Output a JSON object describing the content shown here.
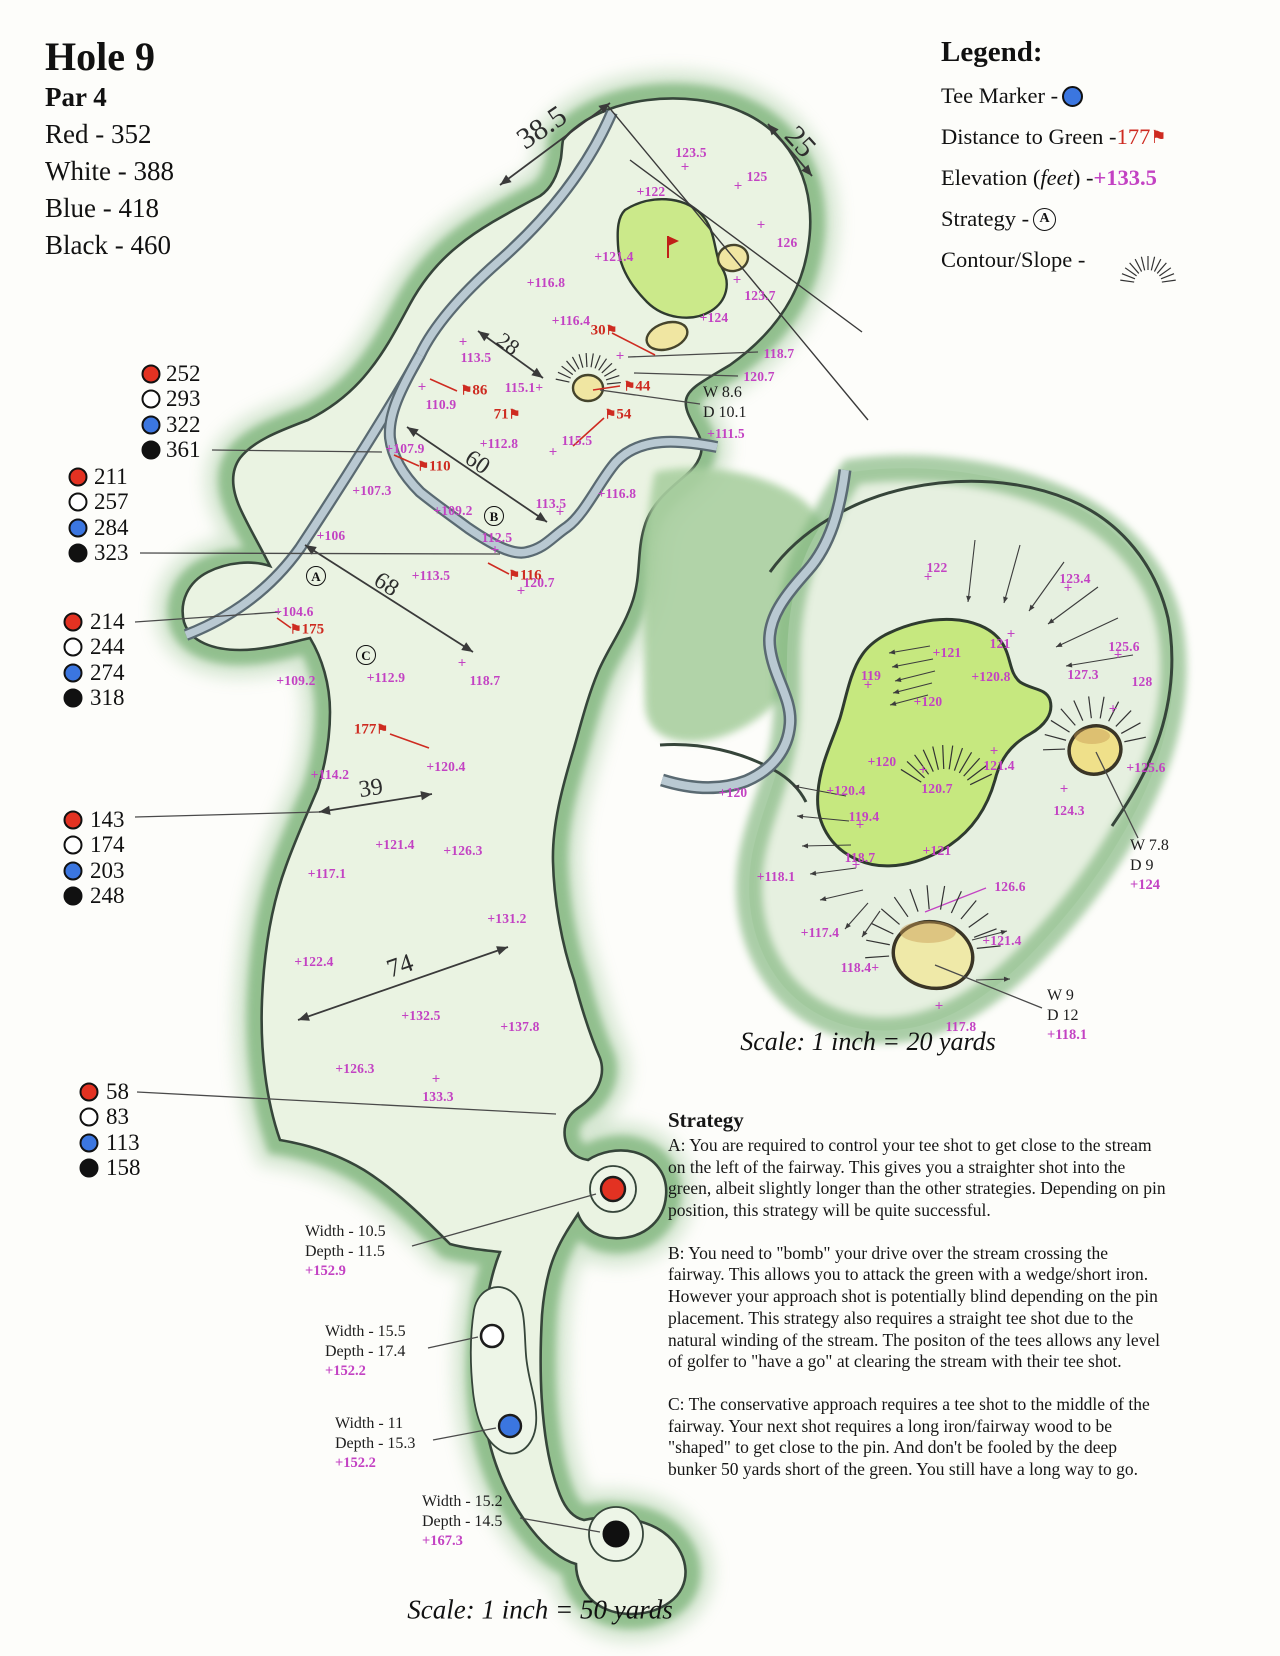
{
  "header": {
    "title": "Hole 9",
    "par": "Par 4",
    "tees": [
      "Red - 352",
      "White - 388",
      "Blue - 418",
      "Black - 460"
    ]
  },
  "legend": {
    "title": "Legend:",
    "tee_marker_label": "Tee Marker - ",
    "distance_label": "Distance to Green - ",
    "distance_value": "177",
    "elevation_pre": "Elevation (",
    "elevation_feet": "feet",
    "elevation_post": ") - ",
    "elevation_value": "+133.5",
    "strategy_label": "Strategy - ",
    "strategy_symbol": "A",
    "contour_label": "Contour/Slope - "
  },
  "colors": {
    "elev": "#c342c3",
    "dist": "#ce2b21",
    "rough": "#7fb57c",
    "fairway": "#eaf3e2",
    "outline": "#36453a",
    "green": "#cbe98a",
    "bunker": "#f0e6a2",
    "stream": "#b9c9d2",
    "stream_edge": "#5a6a72",
    "tee_red": "#e33222",
    "tee_blue": "#3b76e0"
  },
  "tee_groups": [
    {
      "dot_x": 151,
      "text_x": 166,
      "y": 374,
      "rows": [
        {
          "c": "red",
          "v": "252"
        },
        {
          "c": "white",
          "v": "293"
        },
        {
          "c": "blue",
          "v": "322"
        },
        {
          "c": "black",
          "v": "361"
        }
      ]
    },
    {
      "dot_x": 78,
      "text_x": 94,
      "y": 477,
      "rows": [
        {
          "c": "red",
          "v": "211"
        },
        {
          "c": "white",
          "v": "257"
        },
        {
          "c": "blue",
          "v": "284"
        },
        {
          "c": "black",
          "v": "323"
        }
      ]
    },
    {
      "dot_x": 73,
      "text_x": 90,
      "y": 622,
      "rows": [
        {
          "c": "red",
          "v": "214"
        },
        {
          "c": "white",
          "v": "244"
        },
        {
          "c": "blue",
          "v": "274"
        },
        {
          "c": "black",
          "v": "318"
        }
      ]
    },
    {
      "dot_x": 73,
      "text_x": 90,
      "y": 820,
      "rows": [
        {
          "c": "red",
          "v": "143"
        },
        {
          "c": "white",
          "v": "174"
        },
        {
          "c": "blue",
          "v": "203"
        },
        {
          "c": "black",
          "v": "248"
        }
      ]
    },
    {
      "dot_x": 89,
      "text_x": 106,
      "y": 1092,
      "rows": [
        {
          "c": "red",
          "v": "58"
        },
        {
          "c": "white",
          "v": "83"
        },
        {
          "c": "blue",
          "v": "113"
        },
        {
          "c": "black",
          "v": "158"
        }
      ]
    }
  ],
  "annotations": {
    "elevations": [
      [
        691,
        153,
        "123.5"
      ],
      [
        757,
        177,
        "125"
      ],
      [
        651,
        192,
        "+122"
      ],
      [
        787,
        243,
        "126"
      ],
      [
        614,
        257,
        "+121.4"
      ],
      [
        760,
        296,
        "123.7"
      ],
      [
        714,
        318,
        "+124"
      ],
      [
        546,
        283,
        "+116.8"
      ],
      [
        571,
        321,
        "+116.4"
      ],
      [
        476,
        358,
        "113.5"
      ],
      [
        441,
        405,
        "110.9"
      ],
      [
        524,
        388,
        "115.1+"
      ],
      [
        726,
        434,
        "+111.5"
      ],
      [
        779,
        354,
        "118.7"
      ],
      [
        759,
        377,
        "120.7"
      ],
      [
        499,
        444,
        "+112.8"
      ],
      [
        577,
        441,
        "115.5"
      ],
      [
        405,
        449,
        "+107.9"
      ],
      [
        372,
        491,
        "+107.3"
      ],
      [
        453,
        511,
        "+109.2"
      ],
      [
        497,
        538,
        "112.5"
      ],
      [
        551,
        504,
        "113.5"
      ],
      [
        617,
        494,
        "+116.8"
      ],
      [
        331,
        536,
        "+106"
      ],
      [
        431,
        576,
        "+113.5"
      ],
      [
        539,
        583,
        "120.7"
      ],
      [
        294,
        612,
        "+104.6"
      ],
      [
        296,
        681,
        "+109.2"
      ],
      [
        386,
        678,
        "+112.9"
      ],
      [
        485,
        681,
        "118.7"
      ],
      [
        446,
        767,
        "+120.4"
      ],
      [
        330,
        775,
        "+114.2"
      ],
      [
        395,
        845,
        "+121.4"
      ],
      [
        463,
        851,
        "+126.3"
      ],
      [
        327,
        874,
        "+117.1"
      ],
      [
        507,
        919,
        "+131.2"
      ],
      [
        314,
        962,
        "+122.4"
      ],
      [
        421,
        1016,
        "+132.5"
      ],
      [
        520,
        1027,
        "+137.8"
      ],
      [
        355,
        1069,
        "+126.3"
      ],
      [
        438,
        1097,
        "133.3"
      ],
      [
        937,
        568,
        "122"
      ],
      [
        1075,
        579,
        "123.4"
      ],
      [
        947,
        653,
        "+121"
      ],
      [
        1000,
        644,
        "121"
      ],
      [
        1124,
        647,
        "125.6"
      ],
      [
        871,
        676,
        "119"
      ],
      [
        991,
        677,
        "+120.8"
      ],
      [
        1083,
        675,
        "127.3"
      ],
      [
        1142,
        682,
        "128"
      ],
      [
        928,
        702,
        "+120"
      ],
      [
        882,
        762,
        "+120"
      ],
      [
        733,
        793,
        "+120"
      ],
      [
        846,
        791,
        "+120.4"
      ],
      [
        999,
        766,
        "121.4"
      ],
      [
        937,
        789,
        "120.7"
      ],
      [
        937,
        851,
        "+121"
      ],
      [
        864,
        817,
        "119.4"
      ],
      [
        860,
        858,
        "118.7"
      ],
      [
        776,
        877,
        "+118.1"
      ],
      [
        820,
        933,
        "+117.4"
      ],
      [
        1010,
        887,
        "126.6"
      ],
      [
        1002,
        941,
        "+121.4"
      ],
      [
        860,
        968,
        "118.4+"
      ],
      [
        961,
        1027,
        "117.8"
      ],
      [
        1146,
        768,
        "+125.6"
      ],
      [
        1069,
        811,
        "124.3"
      ]
    ],
    "plus_marks": [
      [
        685,
        168
      ],
      [
        738,
        187
      ],
      [
        761,
        226
      ],
      [
        737,
        281
      ],
      [
        463,
        343
      ],
      [
        422,
        388
      ],
      [
        553,
        453
      ],
      [
        495,
        551
      ],
      [
        560,
        513
      ],
      [
        521,
        592
      ],
      [
        462,
        664
      ],
      [
        436,
        1080
      ],
      [
        620,
        357
      ],
      [
        928,
        578
      ],
      [
        1068,
        589
      ],
      [
        1011,
        635
      ],
      [
        1118,
        656
      ],
      [
        868,
        686
      ],
      [
        1113,
        710
      ],
      [
        994,
        752
      ],
      [
        923,
        771
      ],
      [
        860,
        826
      ],
      [
        856,
        866
      ],
      [
        939,
        1007
      ],
      [
        1064,
        790
      ]
    ],
    "distances": [
      {
        "x": 604,
        "y": 331,
        "t": "30",
        "f": "r"
      },
      {
        "x": 474,
        "y": 391,
        "t": "86",
        "f": "l"
      },
      {
        "x": 507,
        "y": 415,
        "t": "71",
        "f": "r"
      },
      {
        "x": 637,
        "y": 387,
        "t": "44",
        "f": "l"
      },
      {
        "x": 618,
        "y": 415,
        "t": "54",
        "f": "l"
      },
      {
        "x": 434,
        "y": 467,
        "t": "110",
        "f": "l"
      },
      {
        "x": 525,
        "y": 576,
        "t": "116",
        "f": "l"
      },
      {
        "x": 307,
        "y": 630,
        "t": "175",
        "f": "l"
      },
      {
        "x": 371,
        "y": 730,
        "t": "177",
        "f": "r"
      }
    ],
    "dims": [
      {
        "x": 542,
        "y": 128,
        "t": "38.5",
        "r": -34,
        "s": 30
      },
      {
        "x": 800,
        "y": 142,
        "t": "25",
        "r": 48,
        "s": 30
      },
      {
        "x": 508,
        "y": 344,
        "t": "28",
        "r": 36,
        "s": 22
      },
      {
        "x": 477,
        "y": 463,
        "t": "60",
        "r": 34,
        "s": 24
      },
      {
        "x": 386,
        "y": 585,
        "t": "68",
        "r": 33,
        "s": 24
      },
      {
        "x": 371,
        "y": 789,
        "t": "39",
        "r": -9,
        "s": 24
      },
      {
        "x": 400,
        "y": 966,
        "t": "74",
        "r": -19,
        "s": 26
      }
    ],
    "dim_arrows": [
      [
        500,
        185,
        610,
        103
      ],
      [
        768,
        124,
        812,
        176
      ],
      [
        478,
        331,
        543,
        378
      ],
      [
        407,
        427,
        547,
        522
      ],
      [
        305,
        545,
        473,
        652
      ],
      [
        319,
        812,
        432,
        794
      ],
      [
        298,
        1020,
        508,
        947
      ]
    ],
    "long_lines": [
      [
        607,
        105,
        868,
        420
      ],
      [
        630,
        160,
        862,
        332
      ]
    ],
    "leader_lines": [
      [
        212,
        450,
        382,
        452
      ],
      [
        140,
        553,
        500,
        554
      ],
      [
        135,
        622,
        280,
        612
      ],
      [
        135,
        817,
        319,
        812
      ],
      [
        137,
        1092,
        556,
        1114
      ],
      [
        628,
        357,
        758,
        352
      ],
      [
        634,
        373,
        738,
        376
      ],
      [
        600,
        390,
        700,
        404
      ],
      [
        412,
        1246,
        596,
        1194
      ],
      [
        428,
        1348,
        478,
        1337
      ],
      [
        433,
        1440,
        496,
        1428
      ],
      [
        520,
        1518,
        600,
        1532
      ],
      [
        1096,
        752,
        1138,
        838
      ],
      [
        935,
        965,
        1042,
        1008
      ]
    ],
    "magenta_leaders": [
      [
        925,
        912,
        986,
        888
      ]
    ],
    "red_leaders": [
      [
        612,
        333,
        655,
        355
      ],
      [
        430,
        379,
        457,
        391
      ],
      [
        593,
        390,
        620,
        386
      ],
      [
        573,
        446,
        604,
        418
      ],
      [
        394,
        455,
        419,
        466
      ],
      [
        488,
        563,
        509,
        574
      ],
      [
        277,
        618,
        291,
        628
      ],
      [
        390,
        734,
        429,
        748
      ]
    ],
    "strategy_points": [
      {
        "x": 316,
        "y": 576,
        "t": "A"
      },
      {
        "x": 494,
        "y": 516,
        "t": "B"
      },
      {
        "x": 366,
        "y": 655,
        "t": "C"
      }
    ],
    "notes": [
      {
        "x": 703,
        "y": 383,
        "lines": [
          "W 8.6",
          "D 10.1"
        ]
      },
      {
        "x": 1047,
        "y": 986,
        "lines": [
          "W 9",
          "D 12"
        ],
        "elev": "+118.1"
      },
      {
        "x": 1130,
        "y": 836,
        "lines": [
          "W 7.8",
          "D 9"
        ],
        "elev": "+124"
      },
      {
        "x": 305,
        "y": 1222,
        "lines": [
          "Width - 10.5",
          "Depth - 11.5"
        ],
        "elev": "+152.9"
      },
      {
        "x": 325,
        "y": 1322,
        "lines": [
          "Width - 15.5",
          "Depth - 17.4"
        ],
        "elev": "+152.2"
      },
      {
        "x": 335,
        "y": 1414,
        "lines": [
          "Width - 11",
          "Depth - 15.3"
        ],
        "elev": "+152.2"
      },
      {
        "x": 422,
        "y": 1492,
        "lines": [
          "Width - 15.2",
          "Depth - 14.5"
        ],
        "elev": "+167.3"
      }
    ],
    "fans": [
      {
        "cx": 588,
        "cy": 386,
        "r1": 19,
        "r2": 33,
        "a1": -168,
        "a2": -6,
        "n": 14
      },
      {
        "cx": 1148,
        "cy": 284,
        "r1": 14,
        "r2": 28,
        "a1": -172,
        "a2": -8,
        "n": 13
      },
      {
        "cx": 945,
        "cy": 797,
        "r1": 28,
        "r2": 52,
        "a1": -148,
        "a2": -26,
        "n": 12
      },
      {
        "cx": 1095,
        "cy": 748,
        "r1": 30,
        "r2": 52,
        "a1": -182,
        "a2": -12,
        "n": 11
      },
      {
        "cx": 933,
        "cy": 953,
        "r1": 44,
        "r2": 68,
        "a1": -184,
        "a2": -6,
        "n": 13
      }
    ],
    "slope_arrows": [
      [
        975,
        540,
        968,
        602
      ],
      [
        1020,
        545,
        1004,
        603
      ],
      [
        1064,
        562,
        1029,
        611
      ],
      [
        1098,
        587,
        1048,
        624
      ],
      [
        1118,
        618,
        1056,
        647
      ],
      [
        1133,
        655,
        1066,
        666
      ],
      [
        930,
        646,
        889,
        653
      ],
      [
        933,
        659,
        892,
        667
      ],
      [
        935,
        671,
        895,
        681
      ],
      [
        932,
        683,
        893,
        693
      ],
      [
        928,
        695,
        890,
        705
      ],
      [
        846,
        796,
        793,
        786
      ],
      [
        849,
        821,
        797,
        816
      ],
      [
        851,
        845,
        802,
        846
      ],
      [
        856,
        868,
        810,
        874
      ],
      [
        863,
        890,
        820,
        900
      ],
      [
        868,
        903,
        845,
        929
      ],
      [
        880,
        911,
        862,
        937
      ],
      [
        972,
        940,
        1007,
        931
      ],
      [
        976,
        980,
        1010,
        979
      ]
    ]
  },
  "scales": {
    "main": {
      "x": 540,
      "y": 1610,
      "text": "Scale: 1 inch = 50 yards"
    },
    "inset": {
      "x": 868,
      "y": 1042,
      "text": "Scale: 1 inch = 20 yards"
    }
  },
  "strategy": {
    "title": "Strategy",
    "paragraphs": [
      "A: You are required to control your tee shot to get close to the stream on the left of the fairway. This gives you a straighter shot into the green, albeit slightly longer than the other strategies. Depending on pin position, this strategy will be quite successful.",
      "B: You need to \"bomb\" your drive over the stream crossing the fairway. This allows you to attack the green with a wedge/short iron. However your approach shot is potentially blind depending on the pin placement. This strategy also requires a straight tee shot due to the natural winding of the stream. The positon of the tees allows any level of golfer to \"have a go\" at clearing the stream with their tee shot.",
      "C: The conservative approach requires a tee shot to the middle of the fairway. Your next shot requires a long iron/fairway wood to be \"shaped\" to get close to the pin. And don't be fooled by the deep bunker 50 yards short of the green. You still have a long way to go."
    ]
  }
}
